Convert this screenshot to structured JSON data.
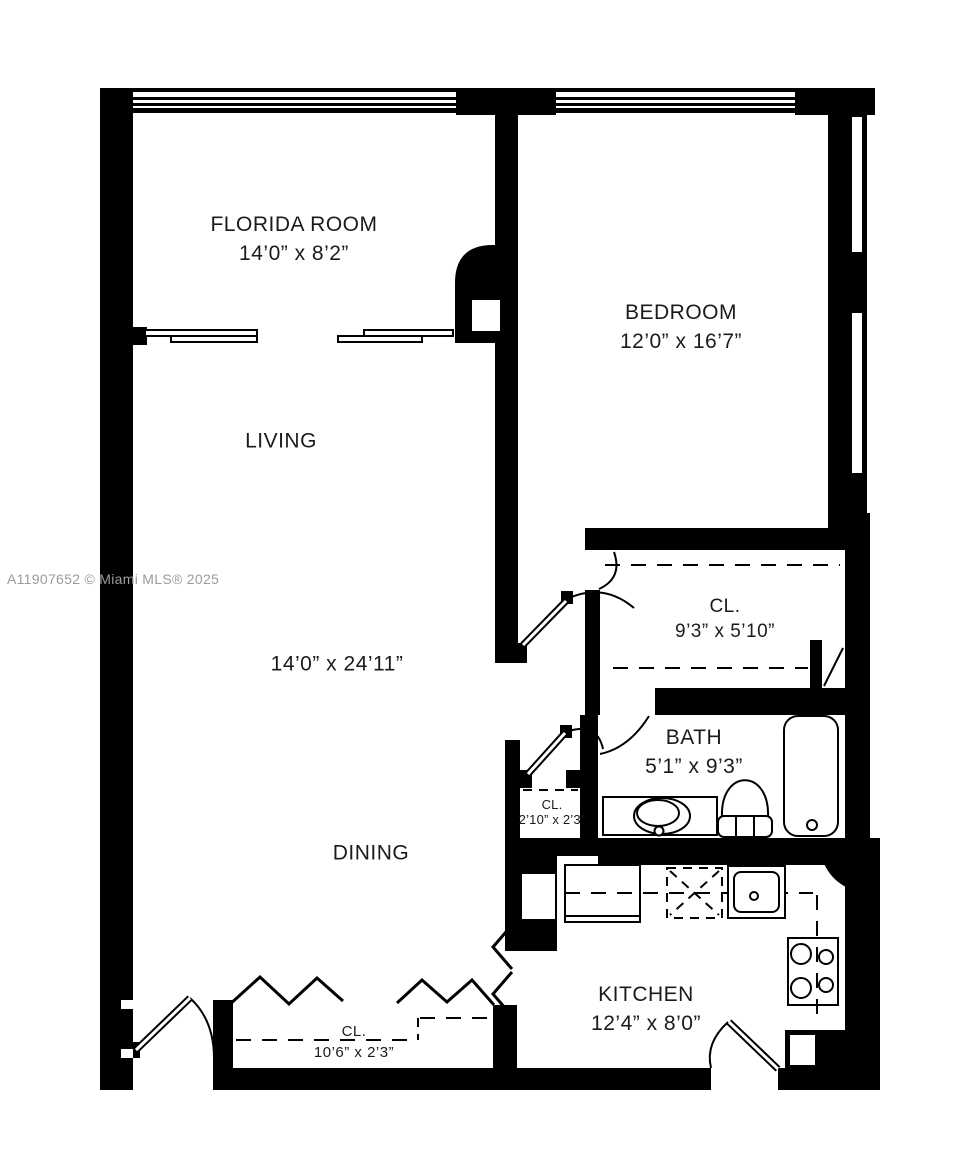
{
  "plan": {
    "watermark": "A11907652 © Miami MLS® 2025",
    "rooms": [
      {
        "name": "FLORIDA ROOM",
        "dims": "14’0” x 8’2”"
      },
      {
        "name": "BEDROOM",
        "dims": "12’0” x 16’7”"
      },
      {
        "name": "LIVING",
        "dims": "14’0” x 24’11”"
      },
      {
        "name": "DINING",
        "dims": ""
      },
      {
        "name": "CL.",
        "dims": "9’3” x 5’10”"
      },
      {
        "name": "BATH",
        "dims": "5’1” x 9’3”"
      },
      {
        "name": "CL.",
        "dims": "2’10” x 2’3”"
      },
      {
        "name": "KITCHEN",
        "dims": "12’4” x 8’0”"
      },
      {
        "name": "CL.",
        "dims": "10’6” x 2’3”"
      }
    ],
    "colors": {
      "wall": "#000000",
      "background": "#ffffff",
      "watermark": "#9b9b9b",
      "label_text": "#1b1b1b"
    },
    "fixtures": [
      "bathtub",
      "toilet",
      "vanity-sink",
      "kitchen-sink",
      "stove-burners",
      "dishwasher",
      "counter",
      "base-cabinet",
      "closet-rod",
      "bifold-doors",
      "door-swing",
      "window-band"
    ]
  }
}
